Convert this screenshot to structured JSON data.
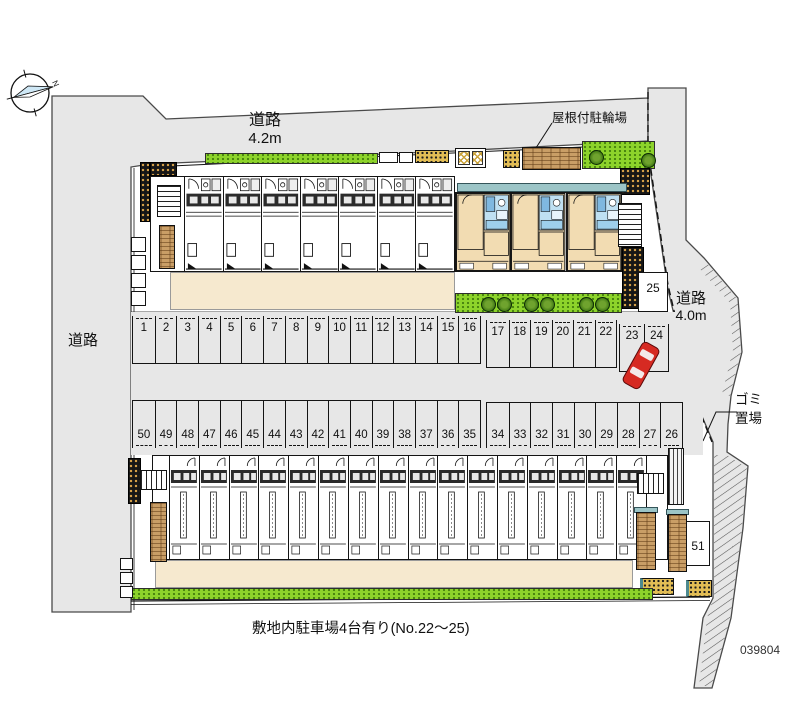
{
  "title_block": {
    "caption": "敷地内駐車場4台有り(No.22～25)",
    "plan_number": "039804"
  },
  "labels": {
    "road_top": {
      "name": "道路",
      "width": "4.2m"
    },
    "road_left": {
      "name": "道路"
    },
    "road_right": {
      "name": "道路",
      "width": "4.0m"
    },
    "bicycle_shed": "屋根付駐輪場",
    "trash_area": [
      "ゴミ",
      "置場"
    ],
    "compass_north": "N"
  },
  "parking": {
    "row_top_group1": [
      "1",
      "2",
      "3",
      "4",
      "5",
      "6",
      "7",
      "8",
      "9",
      "10",
      "11",
      "12",
      "13",
      "14",
      "15",
      "16"
    ],
    "row_top_group2": [
      "17",
      "18",
      "19",
      "20",
      "21",
      "22"
    ],
    "row_top_group3": [
      "23",
      "24"
    ],
    "stall_25": "25",
    "row_mid_group1": [
      "50",
      "49",
      "48",
      "47",
      "46",
      "45",
      "44",
      "43",
      "42",
      "41",
      "40",
      "39",
      "38",
      "37",
      "36",
      "35"
    ],
    "row_mid_group2": [
      "34",
      "33",
      "32",
      "31",
      "30",
      "29",
      "28",
      "27",
      "26"
    ],
    "stall_51": "51"
  },
  "buildings": {
    "upper_left_unit_count": 7,
    "upper_right_unit_count": 3,
    "lower_unit_count": 16
  },
  "landscape": {
    "trees_top_right": 2,
    "trees_mid_strip": 6
  },
  "colors": {
    "road_gray": "#e7e7e7",
    "apron_beige": "#f6e9cf",
    "grass_green": "#8dd32b",
    "tree_green": "#447c16",
    "wood_brown": "#c99e66",
    "room_tan": "#f2dcb2",
    "bath_blue": "#bfe0f2",
    "roof_teal": "#9cc5c7",
    "hatch_dot_orange": "#d9a44a",
    "car_red": "#d62a22"
  }
}
